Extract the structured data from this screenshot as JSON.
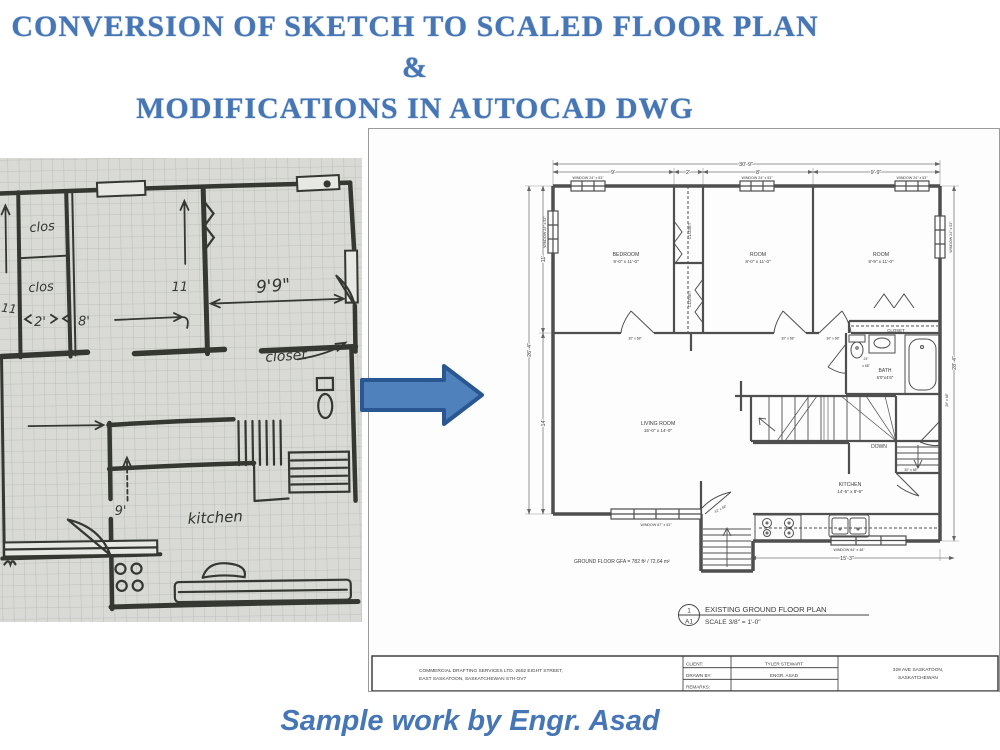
{
  "title": {
    "line1": "CONVERSION OF SKETCH TO SCALED FLOOR PLAN &",
    "line2": "MODIFICATIONS IN AUTOCAD DWG"
  },
  "caption": "Sample work by Engr. Asad",
  "colors": {
    "accent_blue": "#4676b5",
    "arrow_fill": "#4f81bd",
    "arrow_border": "#2a5791"
  },
  "sketch": {
    "labels": {
      "closet_upper": "clos",
      "closet_lower": "clos",
      "closet_right": "closet",
      "dim_9_9": "9'9\"",
      "dim_2": "2'",
      "dim_8": "8'",
      "dim_11a": "11",
      "dim_11b": "11",
      "dim_9": "9'",
      "kitchen": "kitchen"
    }
  },
  "cad": {
    "dimensions": {
      "overall_width": "30'-9\"",
      "seg_1": "9'",
      "seg_2": "2'",
      "seg_3": "8'",
      "seg_4": "9'-9\"",
      "left_total": "26'-4\"",
      "left_upper": "11'",
      "left_lower": "14'",
      "right_total": "28'-4\"",
      "bottom_kitchen": "15'-3\""
    },
    "windows": {
      "top_1": "WINDOW 24\" x 53\"",
      "top_2": "WINDOW 24\" x 53\"",
      "top_3": "WINDOW 24\" x 53\"",
      "left": "WINDOW 24\" x 53\"",
      "right": "WINDOW 24\" x 53\"",
      "bottom_living": "WINDOW 87\" x 53\"",
      "bottom_kitchen": "WINDOW 64\" x 48\""
    },
    "rooms": {
      "bedroom": {
        "name": "BEDROOM",
        "size": "9'-0\" x 11'-0\""
      },
      "room2": {
        "name": "ROOM",
        "size": "8'-0\" x 11'-0\""
      },
      "room3": {
        "name": "ROOM",
        "size": "9'-9\" x 11'-0\""
      },
      "living": {
        "name": "LIVING ROOM",
        "size": "15'-0\" x 14'-0\""
      },
      "kitchen": {
        "name": "KITCHEN",
        "size": "14'-5\" x 8'-6\""
      },
      "bath": {
        "name": "BATH",
        "size": "6'0\"x4'6\""
      }
    },
    "closets": {
      "hall_upper": "CLOSET",
      "hall_lower": "CLOSET",
      "bath": "CLOSET"
    },
    "doors": {
      "bedroom": "30\" x 68\"",
      "room2": "30\" x 68\"",
      "room3": "30\" x 68\"",
      "bath_1": "24\"",
      "bath_2": "x 68\"",
      "side": "26\" x 68\"",
      "kitchen": "30\" x 68\"",
      "entry": "32\" x 68\""
    },
    "stairs_down": "DOWN",
    "gfa": "GROUND FLOOR GFA = 782 ft² / 72.64 m²",
    "callout": {
      "number": "1",
      "sheet": "A1",
      "plan_title": "EXISTING GROUND FLOOR PLAN",
      "scale": "SCALE 3/8\" = 1'-0\""
    },
    "titleblock": {
      "company_line1": "COMMERCIAL DRAFTING SERVICES LTD. 2602 EIGHT STREET,",
      "company_line2": "EAST SASKATOON, SASKATCHEWAN S7H OV7",
      "client_label": "CLIENT:",
      "client_value": "TYLER STEWART",
      "drawn_label": "DRAWN BY:",
      "drawn_value": "ENGR. ASAD",
      "remarks_label": "REMARKS:",
      "remarks_value": "",
      "address_line1": "329 AVE SASKATOON,",
      "address_line2": "SASKATCHEWAN"
    }
  }
}
